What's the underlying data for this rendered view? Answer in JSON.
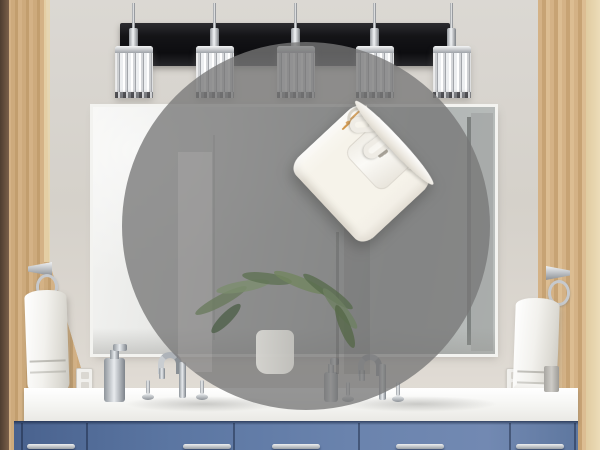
{
  "scene": {
    "type": "bathroom-vanity-product-photo",
    "width": 600,
    "height": 450,
    "description": "Bathroom with blue double vanity, large mirror, five-light crystal fixture; circular gray zoom overlay showing a G9 LED bulb"
  },
  "colors": {
    "wall": "#d5d1ca",
    "wood": "#c7a374",
    "fixture_bar": "#141417",
    "mirror_glass": "#c2c6c5",
    "counter": "#f4f4f1",
    "cabinet_blue": "#5b76a2",
    "chrome": "#b9bdc2",
    "overlay_gray": "rgba(119,119,119,0.78)",
    "led_chip_orange": "#f8920c",
    "led_chip_yellow": "#f6a71e",
    "ceramic_white": "#f6f3ea",
    "towel_white": "#f2f1ed",
    "plant_green": "#6a7b5e"
  },
  "fixture": {
    "style": "crystal-cube-vanity-lights",
    "light_count": 5,
    "light_centers_x": [
      134,
      215,
      296,
      375,
      452
    ]
  },
  "zoom_circle": {
    "shape": "circle",
    "cx": 306,
    "cy": 226,
    "r": 184,
    "purpose": "product-zoom-overlay"
  },
  "bulb": {
    "name": "G9 LED corn bulb",
    "base_type": "G9 looped pins",
    "pin_count": 2,
    "tilt_deg": 47,
    "body_columns": [
      {
        "count": 4,
        "top": 12,
        "width": 19,
        "chip_h": 15,
        "squash": 0.78
      },
      {
        "count": 5,
        "top": 4,
        "width": 24,
        "chip_h": 16,
        "squash": 1
      },
      {
        "count": 5,
        "top": 0,
        "width": 24,
        "chip_h": 16,
        "squash": 1
      },
      {
        "count": 4,
        "top": 10,
        "width": 19,
        "chip_h": 15,
        "squash": 0.8
      }
    ],
    "dome_chip_rows": [
      3,
      4,
      3
    ],
    "base_slot_count": 3
  },
  "vanity": {
    "drawer_pull_style": "chrome-bar",
    "seams_x": [
      7,
      72,
      219,
      344,
      495,
      560
    ],
    "pull_centers_x": [
      37,
      193,
      282,
      406,
      526
    ]
  },
  "plant": {
    "leaves": [
      {
        "x": 70,
        "y": 253,
        "w": 58,
        "rot": -28,
        "color": "#6a7b5e"
      },
      {
        "x": 94,
        "y": 239,
        "w": 54,
        "rot": -10,
        "color": "#7c8d6e"
      },
      {
        "x": 120,
        "y": 231,
        "w": 50,
        "rot": 8,
        "color": "#5f7254"
      },
      {
        "x": 150,
        "y": 235,
        "w": 56,
        "rot": 22,
        "color": "#72855f"
      },
      {
        "x": 176,
        "y": 244,
        "w": 60,
        "rot": 35,
        "color": "#596b4e"
      },
      {
        "x": 192,
        "y": 261,
        "w": 52,
        "rot": 50,
        "color": "#6e8062"
      },
      {
        "x": 84,
        "y": 271,
        "w": 40,
        "rot": -45,
        "color": "#4f604a"
      },
      {
        "x": 200,
        "y": 279,
        "w": 46,
        "rot": 68,
        "color": "#566849"
      }
    ]
  },
  "towels": {
    "left": "white hand towel on chrome ring",
    "right": "white hand towel on chrome ring"
  },
  "outlets": [
    {
      "x": 76,
      "y": 368
    },
    {
      "x": 506,
      "y": 368
    }
  ]
}
